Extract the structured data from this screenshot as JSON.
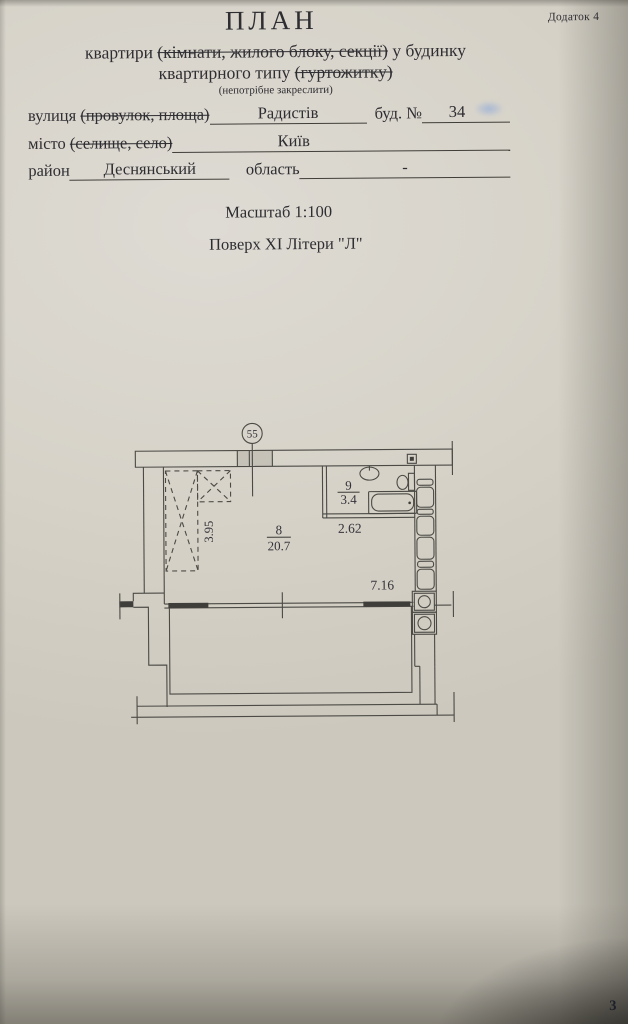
{
  "page": {
    "appendix": "Додаток 4",
    "title": "ПЛАН",
    "subtitle": {
      "line1_pre": "квартири ",
      "line1_struck": "(кімнати, жилого блоку, секції)",
      "line1_post": " у будинку",
      "line2_pre": "квартирного типу ",
      "line2_struck": "(гуртожитку)",
      "note": "(непотрібне закреслити)"
    },
    "form": {
      "street_label": "вулиця ",
      "street_label_struck": "(провулок, площа)",
      "street_value": "Радистів",
      "building_label": "буд. №",
      "building_value": "34",
      "city_label": "місто ",
      "city_label_struck": "(селище, село)",
      "city_value": "Київ",
      "district_label": "район",
      "district_value": "Деснянський",
      "region_label": "область",
      "region_value": "-"
    },
    "scale_line": "Масштаб 1:100",
    "floor_line": "Поверх XI Літери \"Л\"",
    "page_number": "3"
  },
  "plan": {
    "node_number": "55",
    "rooms": [
      {
        "number": "8",
        "area": "20.7"
      },
      {
        "number": "9",
        "area": "3.4"
      }
    ],
    "dimensions": {
      "wardrobe_depth": "3.95",
      "bathroom_width": "2.62",
      "room_width": "7.16"
    },
    "colors": {
      "ink": "#4b4a45",
      "paper": "#d6d2c8"
    }
  }
}
